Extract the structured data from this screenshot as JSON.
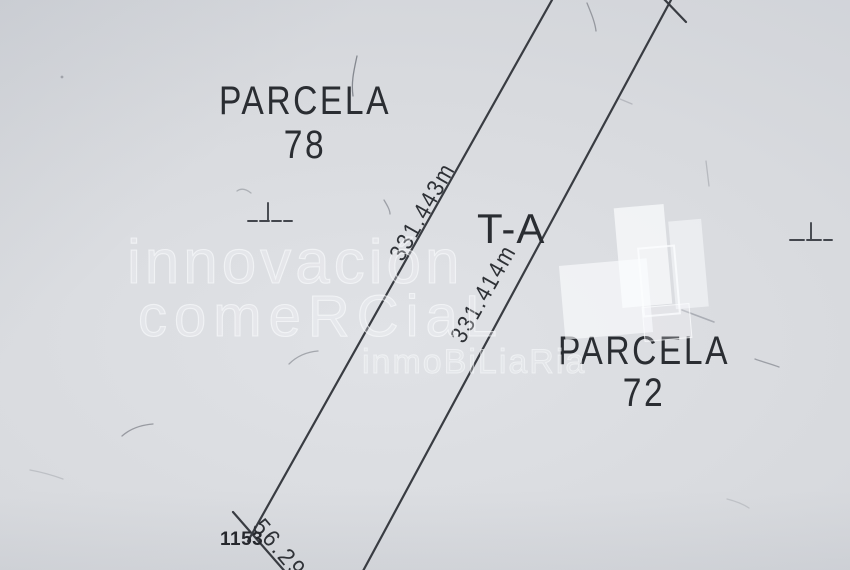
{
  "plan": {
    "parcel_left": {
      "label": "PARCELA",
      "number": "78"
    },
    "parcel_right": {
      "label": "PARCELA",
      "number": "72"
    },
    "strip": {
      "label": "T-A",
      "left_boundary_length": "331.443m",
      "right_boundary_length": "331.414m",
      "bottom_edge_length": "56.29",
      "station_number": "1153"
    }
  },
  "watermark": {
    "line1": "innovación",
    "line2": "comeRCiaL",
    "line3": "inmoBiLiaRia"
  },
  "colors": {
    "paper": "#d8dade",
    "ink": "#35383e",
    "label_text": "#2a2d32",
    "watermark_white": "#f8fafc"
  }
}
